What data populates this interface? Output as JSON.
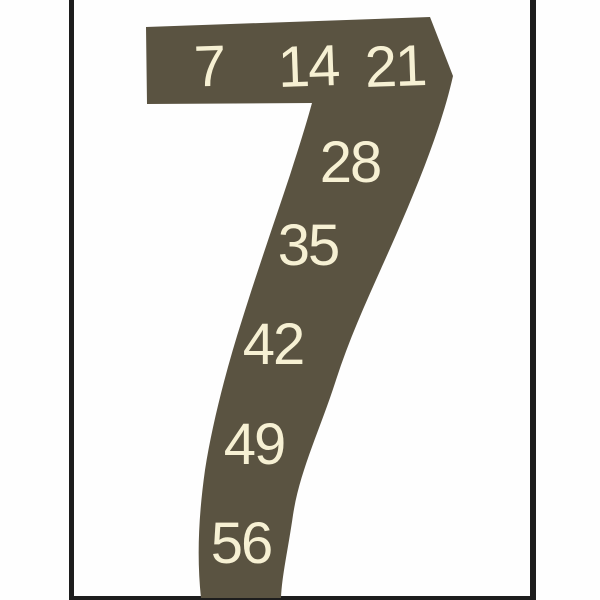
{
  "colors": {
    "background": "#fefefe",
    "shape": "#5a5341",
    "digits": "#f6f0d3",
    "frame": "#1d1d1d"
  },
  "poster": {
    "numeral": "7",
    "labels": [
      {
        "text": "7"
      },
      {
        "text": "14"
      },
      {
        "text": "21"
      },
      {
        "text": "28"
      },
      {
        "text": "35"
      },
      {
        "text": "42"
      },
      {
        "text": "49"
      },
      {
        "text": "56"
      }
    ]
  }
}
